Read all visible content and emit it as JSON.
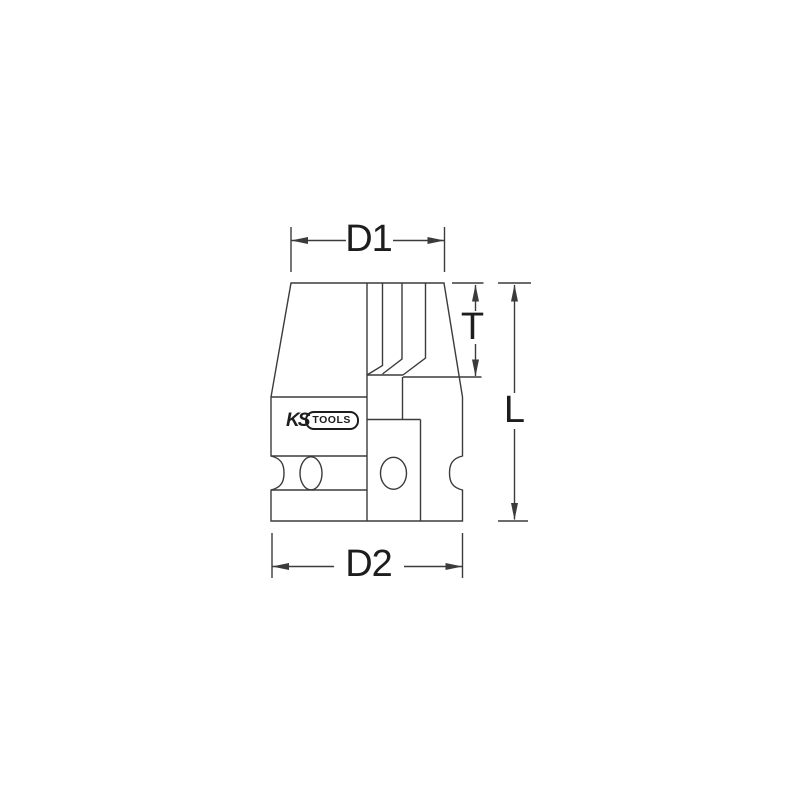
{
  "figure": {
    "background": "#ffffff",
    "line_color": "#3b3b3b",
    "text_color": "#1d1d1d"
  },
  "dimension_labels": {
    "d1": "D1",
    "d2": "D2",
    "t": "T",
    "l": "L"
  },
  "logo": {
    "ks": "KS",
    "tools": "TOOLS"
  }
}
